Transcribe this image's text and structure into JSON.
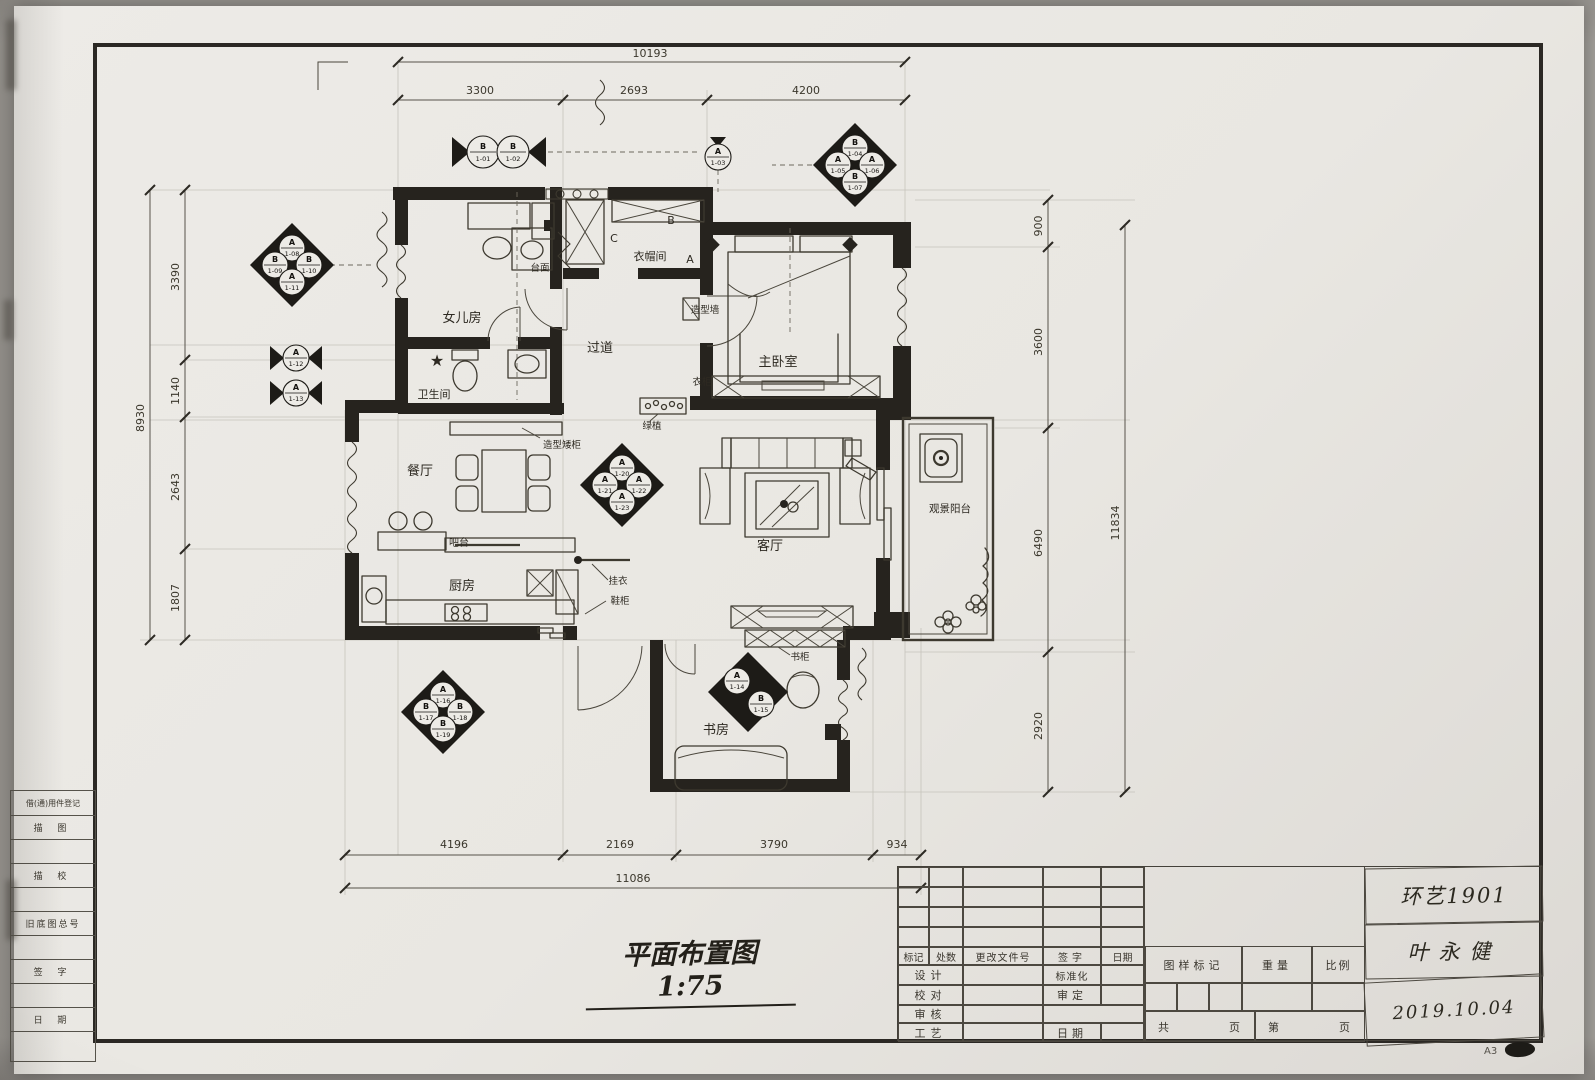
{
  "sheet": {
    "label": "A3"
  },
  "title": {
    "text": "平面布置图 1:75"
  },
  "dims": {
    "top": {
      "total": "10193",
      "seg": [
        "3300",
        "2693",
        "4200"
      ]
    },
    "bottom": {
      "total": "11086",
      "seg": [
        "4196",
        "2169",
        "3790",
        "934"
      ]
    },
    "left": {
      "total": "8930",
      "seg": [
        "3390",
        "1140",
        "2643",
        "1807"
      ]
    },
    "right": {
      "total": "11834",
      "seg": [
        "900",
        "3600",
        "6490",
        "2920"
      ]
    }
  },
  "rooms": {
    "daughter": "女儿房",
    "closet": "衣帽间",
    "master": "主卧室",
    "corridor": "过道",
    "bath": "卫生间",
    "dining": "餐厅",
    "bar": "吧台",
    "kitchen": "厨房",
    "living": "客厅",
    "balcony": "观景阳台",
    "study": "书房"
  },
  "ann": {
    "counter": "台面",
    "feature_wall": "造型墙",
    "wardrobe": "衣柜",
    "console": "造型矮柜",
    "planter": "绿植",
    "coat_rack": "挂衣",
    "shoe_cabinet": "鞋柜",
    "bookcase": "书柜"
  },
  "letters": {
    "a": "A",
    "b": "B",
    "c": "C"
  },
  "markers": {
    "p1": [
      {
        "letter": "B",
        "code": "1-01"
      },
      {
        "letter": "B",
        "code": "1-02"
      }
    ],
    "s1": {
      "letter": "A",
      "code": "1-03"
    },
    "q1": [
      {
        "letter": "B",
        "code": "1-04"
      },
      {
        "letter": "A",
        "code": "1-05"
      },
      {
        "letter": "A",
        "code": "1-06"
      },
      {
        "letter": "B",
        "code": "1-07"
      }
    ],
    "q2": [
      {
        "letter": "A",
        "code": "1-08"
      },
      {
        "letter": "B",
        "code": "1-09"
      },
      {
        "letter": "B",
        "code": "1-10"
      },
      {
        "letter": "A",
        "code": "1-11"
      }
    ],
    "s2": {
      "letter": "A",
      "code": "1-12"
    },
    "s3": {
      "letter": "A",
      "code": "1-13"
    },
    "q3": [
      {
        "letter": "A",
        "code": "1-20"
      },
      {
        "letter": "A",
        "code": "1-21"
      },
      {
        "letter": "A",
        "code": "1-22"
      },
      {
        "letter": "A",
        "code": "1-23"
      }
    ],
    "q4": [
      {
        "letter": "A",
        "code": "1-16"
      },
      {
        "letter": "B",
        "code": "1-17"
      },
      {
        "letter": "B",
        "code": "1-18"
      },
      {
        "letter": "B",
        "code": "1-19"
      }
    ],
    "p2": [
      {
        "letter": "A",
        "code": "1-14"
      },
      {
        "letter": "B",
        "code": "1-15"
      }
    ]
  },
  "title_block": {
    "rev_header": [
      "标记",
      "处数",
      "更改文件号",
      "签字",
      "日期"
    ],
    "rows": [
      {
        "left": "设计",
        "right": "标准化"
      },
      {
        "left": "校对",
        "right": "审定"
      },
      {
        "left": "审核",
        "right": ""
      },
      {
        "left": "工艺",
        "right": "日期"
      }
    ],
    "mark_label": "图样标记",
    "weight_label": "重量",
    "scale_label": "比例",
    "pages": {
      "gong": "共",
      "ye1": "页",
      "di": "第",
      "ye2": "页"
    },
    "course": "环艺1901",
    "author": "叶永健",
    "date": "2019.10.04"
  },
  "side_strip": {
    "rows": [
      "借(通)用件登记",
      "描  图",
      "",
      "描  校",
      "",
      "旧底图总号",
      "",
      "签  字",
      "",
      "日  期",
      ""
    ]
  }
}
